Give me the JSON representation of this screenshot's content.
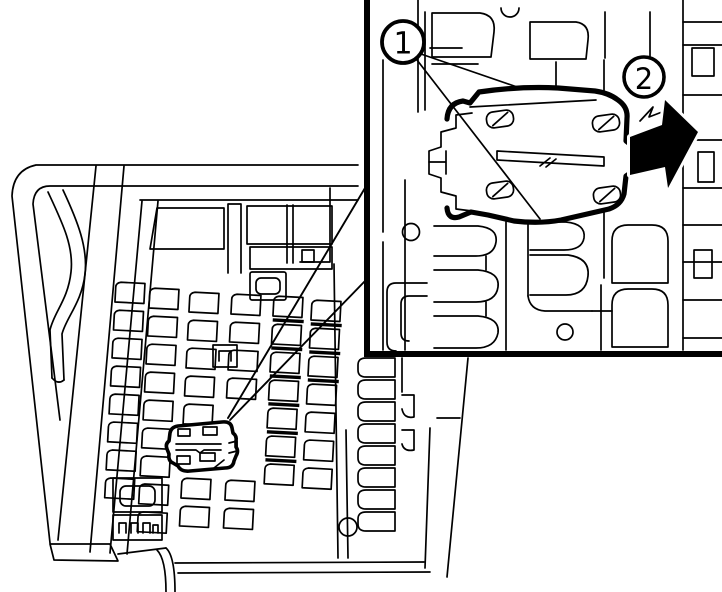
{
  "figure": {
    "background_color": "#ffffff",
    "line_color": "#000000",
    "callouts": {
      "callout_1": {
        "label": "1"
      },
      "callout_2": {
        "label": "2"
      }
    },
    "arrow": {
      "direction": "right",
      "color": "#000000"
    }
  }
}
